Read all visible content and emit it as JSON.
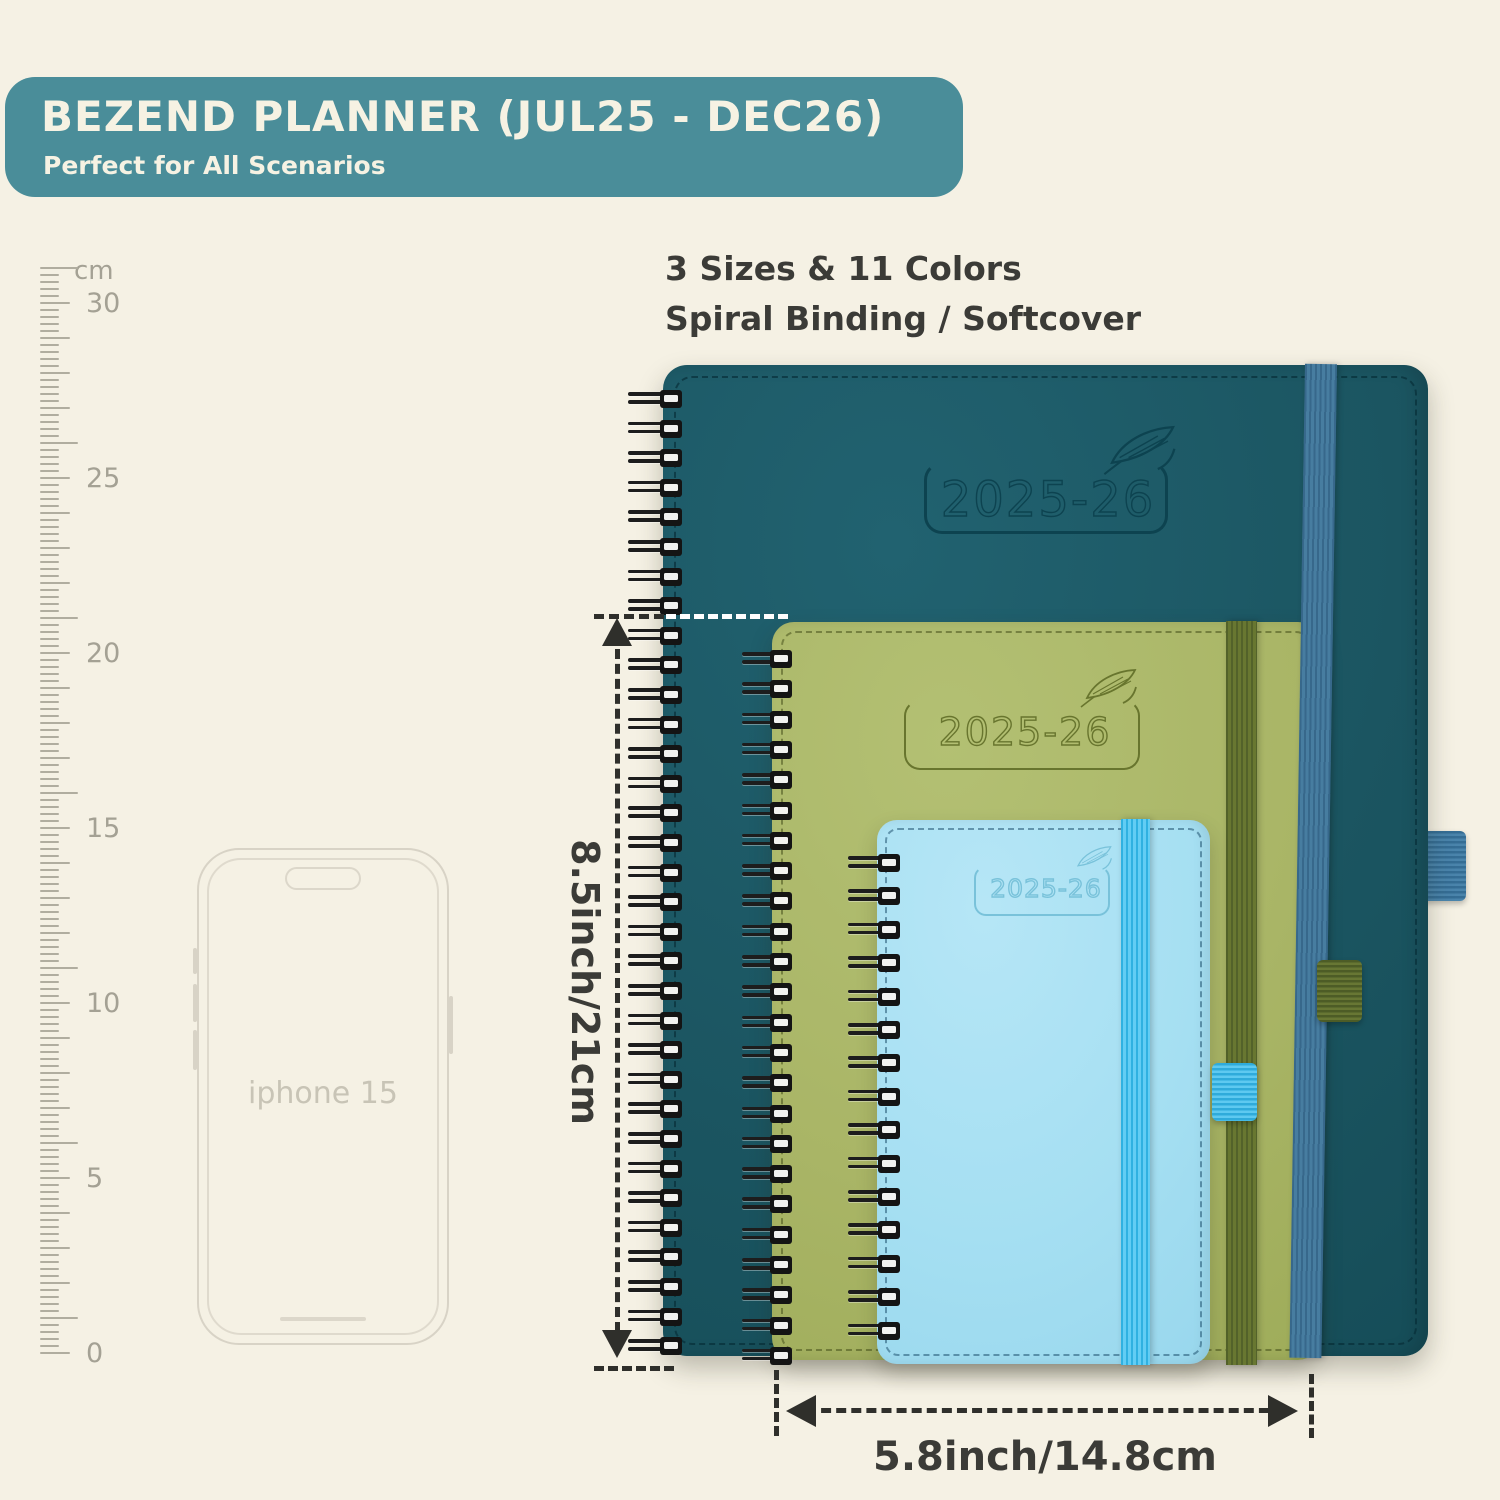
{
  "banner": {
    "title": "BEZEND PLANNER (JUL25 - DEC26)",
    "subtitle": "Perfect for All Scenarios",
    "bg_color": "#4a8d99",
    "text_color": "#f6f2e3"
  },
  "info": {
    "line1": "3 Sizes & 11 Colors",
    "line2": "Spiral Binding / Softcover"
  },
  "ruler": {
    "unit": "cm",
    "labels": [
      "30",
      "25",
      "20",
      "15",
      "10",
      "5",
      "0"
    ]
  },
  "phone": {
    "label": "iphone 15"
  },
  "planners": [
    {
      "size": "large",
      "year_label": "2025-26",
      "cover_color": "#1b5561",
      "band_color": "#3f7697",
      "logo_color": "#0d4350"
    },
    {
      "size": "medium",
      "year_label": "2025-26",
      "cover_color": "#a9b566",
      "band_color": "#5d6c31",
      "logo_color": "#68752e"
    },
    {
      "size": "small",
      "year_label": "2025-26",
      "cover_color": "#a5dff2",
      "band_color": "#45bfe8",
      "logo_color": "#79c2da"
    }
  ],
  "dimensions": {
    "height_label": "8.5inch/21cm",
    "width_label": "5.8inch/14.8cm",
    "annotation_color": "#2f2f2b"
  },
  "icons": {
    "feather": "quill-feather engraved on each cover"
  },
  "background_color": "#f5f1e4"
}
